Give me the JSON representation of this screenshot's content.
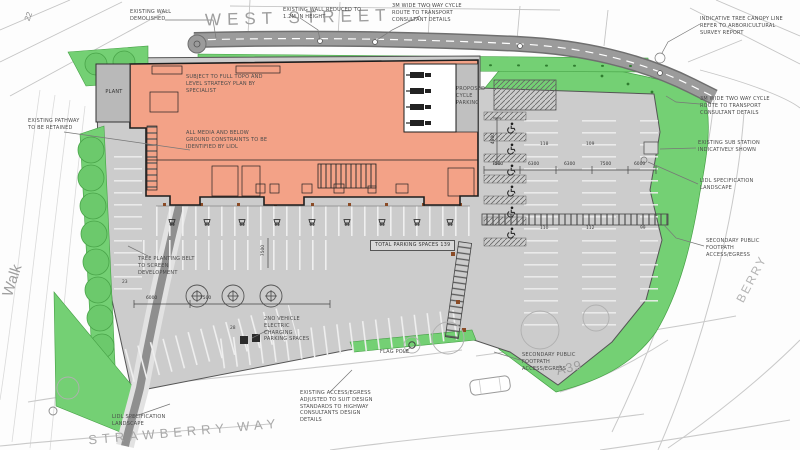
{
  "plan": {
    "streets": {
      "west": "WEST STREET",
      "strawberry": "STRAWBERRY WAY",
      "a39": "A39",
      "berry": "BERRY",
      "walk": "Walk",
      "plot": "22"
    },
    "building": {
      "topo_note": "SUBJECT TO FULL TOPO AND\nLEVEL STRATEGY PLAN BY\nSPECIALIST",
      "media_note": "ALL MEDIA AND BELOW\nGROUND CONSTRAINTS TO BE\nIDENTIFIED BY LIDL",
      "plant": "PLANT"
    },
    "annotations": {
      "wall_demolished": "EXISTING WALL\nDEMOLISHED",
      "wall_reduced": "EXISTING WALL REDUCED TO\n1.2M IN HEIGHT",
      "cycle_route": "3M WIDE TWO WAY CYCLE\nROUTE TO TRANSPORT\nCONSULTANT DETAILS",
      "canopy": "INDICATIVE TREE CANOPY LINE\nREFER TO ARBORICULTURAL\nSURVEY REPORT",
      "substation": "EXISTING SUB STATION\nINDICATIVELY SHOWN",
      "landscape": "LIDL SPECIFICATION\nLANDSCAPE",
      "secondary_footpath": "SECONDARY PUBLIC\nFOOTPATH\nACCESS/EGRESS",
      "pathway": "EXISTING PATHWAY\nTO BE RETAINED",
      "cycle_parking": "PROPOSED CYCLE\nPARKING",
      "tree_belt": "TREE PLANTING BELT\nTO SCREEN\nDEVELOPMENT",
      "total_parking": "TOTAL PARKING SPACES  139",
      "ev": "2NO VEHICLE\nELECTRIC\nCHARGING\nPARKING SPACES",
      "flag_pole": "FLAG POLE",
      "access": "EXISTING ACCESS/EGRESS\nADJUSTED TO SUIT DESIGN\nSTANDARDS TO HIGHWAY\nCONSULTANTS DESIGN\nDETAILS"
    },
    "dimensions": {
      "a": "7500",
      "b": "6300",
      "c": "6300",
      "d": "7500",
      "e": "6000",
      "f": "4800",
      "g": "6000",
      "h": "7500",
      "v1": "7500"
    },
    "bays": {
      "n1": "118",
      "n2": "109",
      "n3": "110",
      "n4": "112",
      "n5": "99",
      "n6": "23",
      "n7": "28"
    },
    "colors": {
      "building": "#f3a287",
      "landscape": "#74d074",
      "road": "#9b9b9b",
      "hardstanding": "#cccccc",
      "pathway": "#8f8f8f"
    }
  }
}
